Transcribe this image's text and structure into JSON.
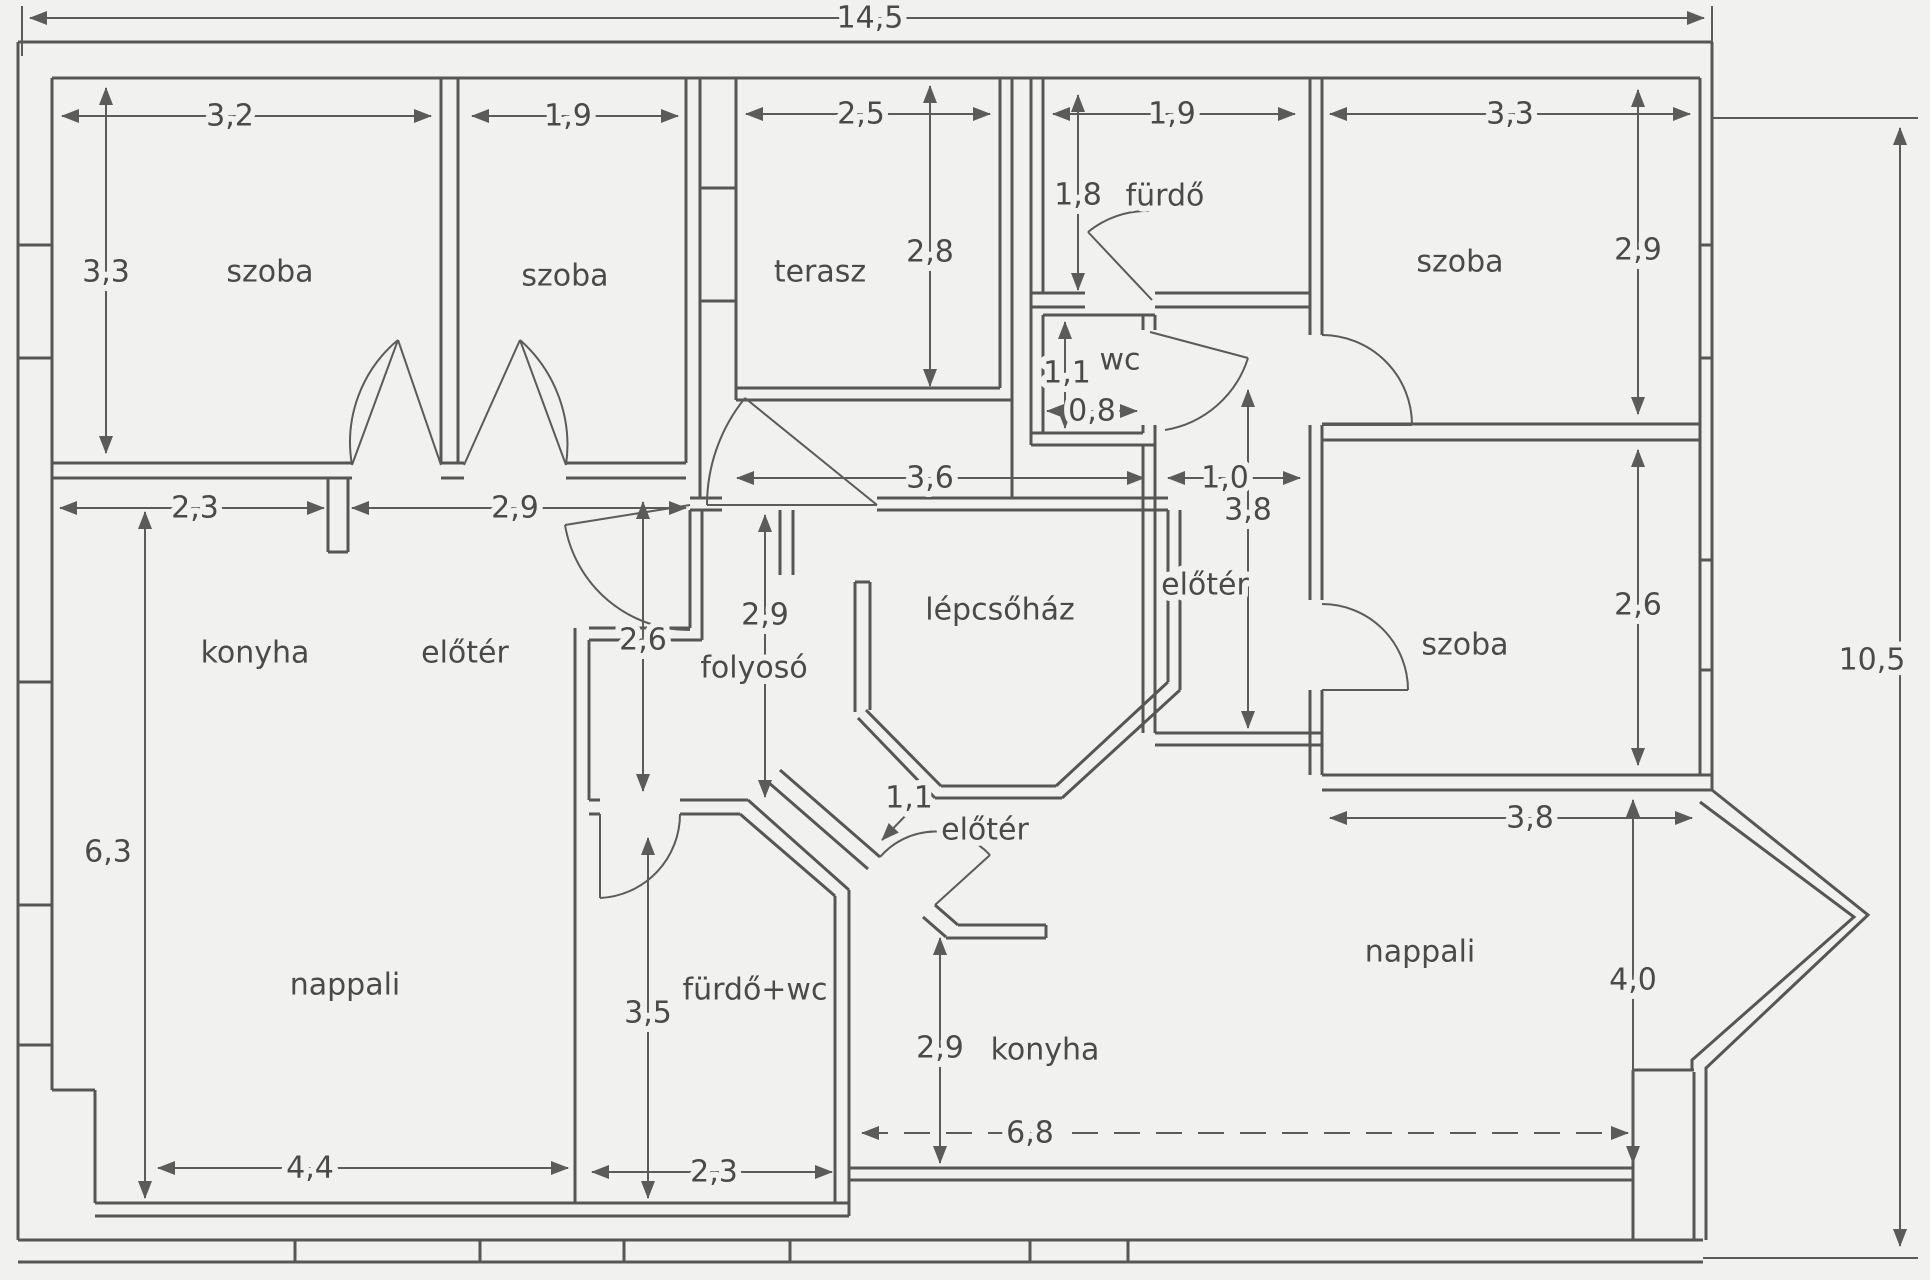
{
  "title": "Hungarian floor plan sketch",
  "colors": {
    "background": "#f1f1ef",
    "wall_line": "#565656",
    "text": "#4a4a4a"
  },
  "units_note": "meters with comma decimals",
  "labels": {
    "total_width": "14,5",
    "total_height": "10,5",
    "szoba1_name": "szoba",
    "szoba1_width": "3,2",
    "szoba1_height": "3,3",
    "szoba2_name": "szoba",
    "szoba2_width": "1,9",
    "terasz_name": "terasz",
    "terasz_width": "2,5",
    "terasz_height": "2,8",
    "furdo_name": "fürdő",
    "furdo_width": "1,9",
    "furdo_height": "1,8",
    "wc_name": "wc",
    "wc_height": "1,1",
    "wc_width": "0,8",
    "szoba3_name": "szoba",
    "szoba3_width": "3,3",
    "szoba3_height": "2,9",
    "szoba4_name": "szoba",
    "szoba4_height": "2,6",
    "szoba4_width": "3,8",
    "eloter_right_name": "előtér",
    "eloter_right_width": "1,0",
    "eloter_right_height": "3,8",
    "lepcsohaz_name": "lépcsőház",
    "lepcsohaz_width": "3,6",
    "folyoso_name": "folyosó",
    "folyoso_height": "2,9",
    "konyha_left_name": "konyha",
    "konyha_left_width": "2,3",
    "eloter_left_name": "előtér",
    "eloter_left_width": "2,9",
    "eloter_left_door": "2,6",
    "nappali_left_name": "nappali",
    "nappali_left_height": "6,3",
    "nappali_left_width": "4,4",
    "furdowc_name": "fürdő+wc",
    "furdowc_height": "3,5",
    "furdowc_width": "2,3",
    "eloter_bottom_name": "előtér",
    "eloter_bottom_door": "1,1",
    "konyha_right_name": "konyha",
    "konyha_right_height": "2,9",
    "nappali_right_name": "nappali",
    "nappali_right_height": "4,0",
    "nappali_right_width": "6,8"
  }
}
